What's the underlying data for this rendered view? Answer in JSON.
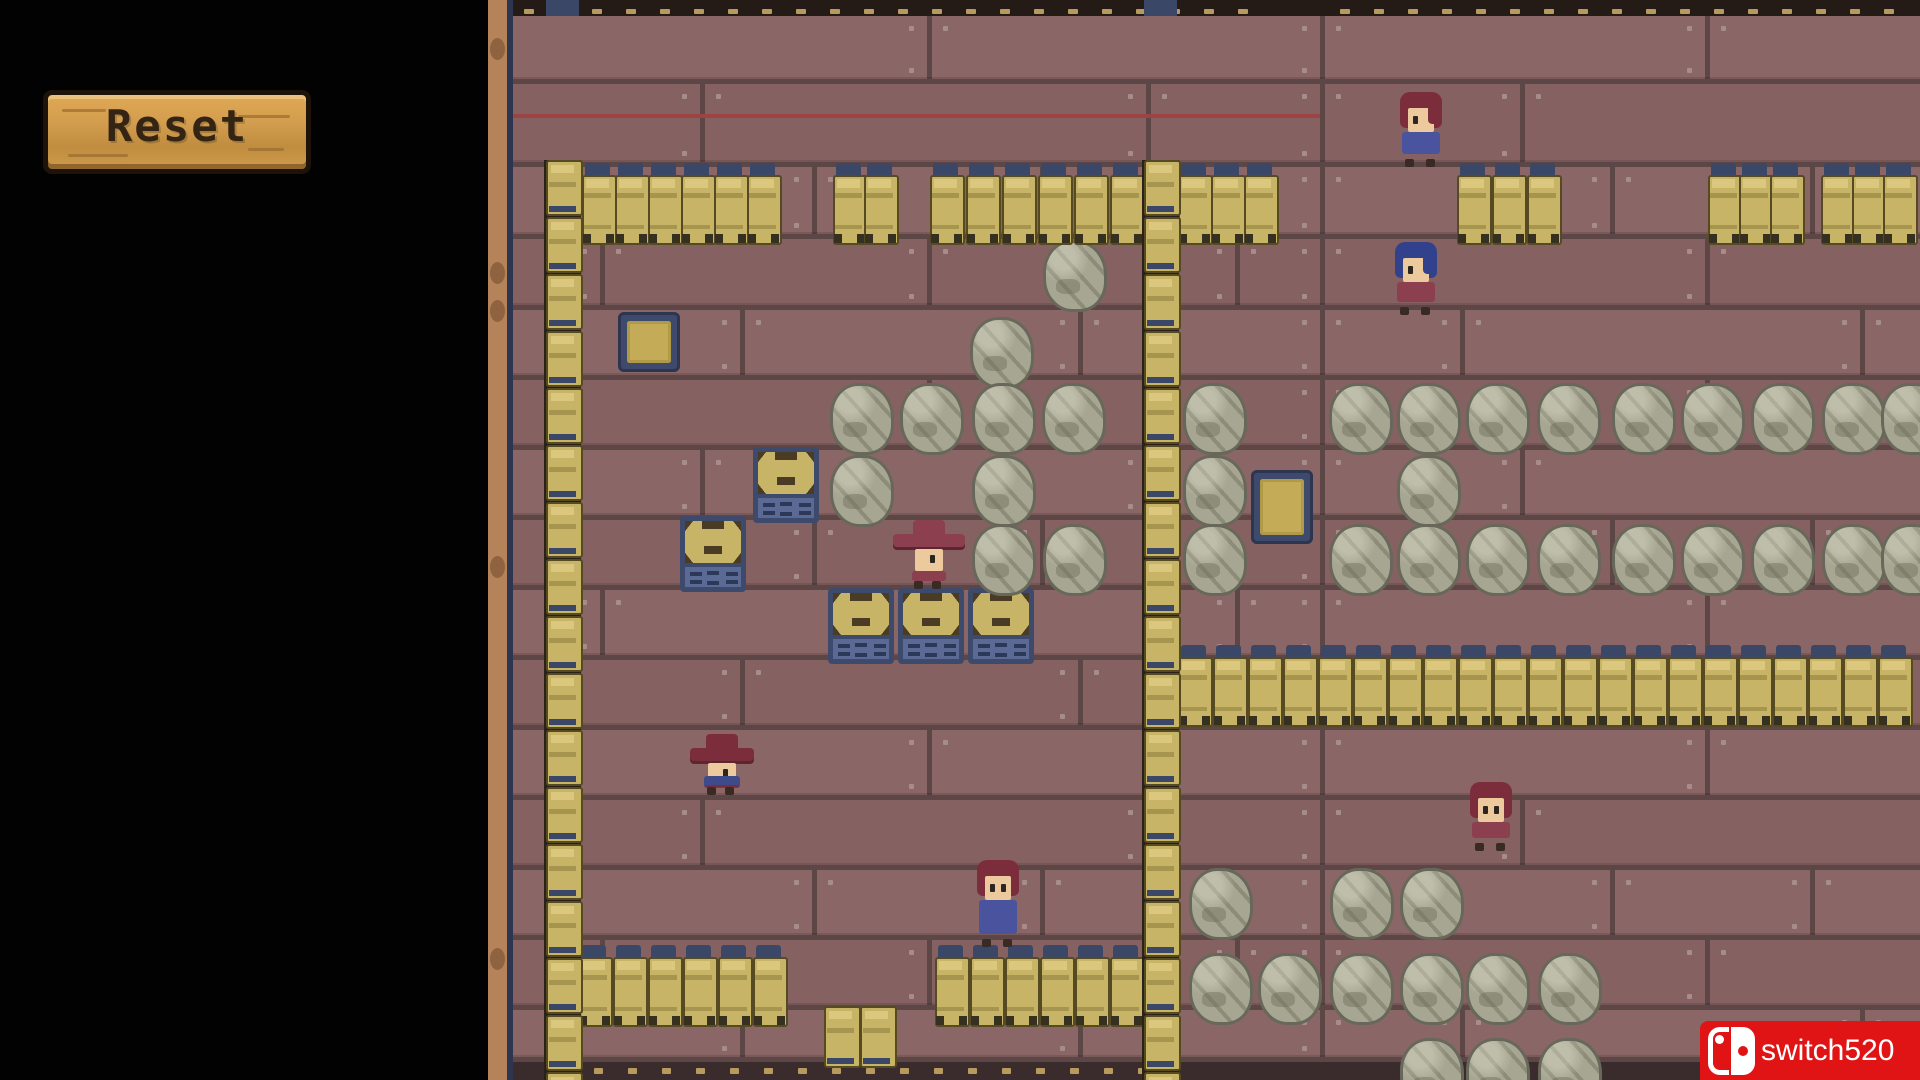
{
  "sidebar": {
    "reset_label": "Reset"
  },
  "watermark": {
    "text": "switch520",
    "bg": "#e01414",
    "fg": "#ffffff"
  },
  "palette": {
    "plank": "#8b6666",
    "plank_alt": "#866161",
    "seam": "#5d4646",
    "seam_red": "#9c4343",
    "nail": "#a78c8c",
    "strip_dark": "#241b17",
    "strip_bottom": "#3a2c2c",
    "navy": "#3b4766",
    "edge_navy": "#2e3550",
    "beam": "#b5835a",
    "barrel": "#c8b466",
    "barrel_light": "#dbc87e",
    "barrel_band": "#a6954f",
    "rock": "#a6a692",
    "crate_top": "#c8b466",
    "crate_bottom": "#5a6a94",
    "crate_frame": "#3e4a6b",
    "switch_gold": "#c3ab57",
    "skin": "#ecca9e"
  },
  "game": {
    "top_strip": {
      "y": 0,
      "h": 16,
      "x1": 513,
      "x2": 1920
    },
    "bottom_strip": {
      "y": 1062,
      "h": 18,
      "x1": 513,
      "x2": 1920,
      "dash_x1": 560,
      "dash_x2": 1145
    },
    "red_seam": {
      "y": 114,
      "x1": 513,
      "x2": 1320
    },
    "seam_rows": [
      16,
      84,
      167,
      239,
      310,
      380,
      450,
      520,
      590,
      660,
      730,
      800,
      870,
      940,
      1010
    ],
    "wall_columns": [
      {
        "x": 546,
        "y1": 160,
        "y2": 1080
      },
      {
        "x": 1144,
        "y1": 160,
        "y2": 1080
      }
    ],
    "barrel_rows": [
      {
        "x": 582,
        "y": 163,
        "count": 6,
        "pitch": 33
      },
      {
        "x": 833,
        "y": 163,
        "count": 2,
        "pitch": 31
      },
      {
        "x": 930,
        "y": 163,
        "count": 6,
        "pitch": 36
      },
      {
        "x": 1178,
        "y": 163,
        "count": 3,
        "pitch": 33
      },
      {
        "x": 1457,
        "y": 163,
        "count": 3,
        "pitch": 35
      },
      {
        "x": 1708,
        "y": 163,
        "count": 3,
        "pitch": 31
      },
      {
        "x": 1821,
        "y": 163,
        "count": 3,
        "pitch": 31
      },
      {
        "x": 1178,
        "y": 645,
        "count": 21,
        "pitch": 35
      },
      {
        "x": 578,
        "y": 945,
        "count": 6,
        "pitch": 35
      },
      {
        "x": 935,
        "y": 945,
        "count": 6,
        "pitch": 35
      }
    ],
    "small_kegs": [
      {
        "x": 824,
        "y": 1006
      },
      {
        "x": 860,
        "y": 1006
      }
    ],
    "rocks": [
      {
        "x": 1043,
        "y": 240
      },
      {
        "x": 970,
        "y": 317
      },
      {
        "x": 830,
        "y": 383
      },
      {
        "x": 900,
        "y": 383
      },
      {
        "x": 972,
        "y": 383
      },
      {
        "x": 1042,
        "y": 383
      },
      {
        "x": 830,
        "y": 455
      },
      {
        "x": 972,
        "y": 455
      },
      {
        "x": 972,
        "y": 524
      },
      {
        "x": 1043,
        "y": 524
      },
      {
        "x": 1183,
        "y": 383
      },
      {
        "x": 1329,
        "y": 383
      },
      {
        "x": 1397,
        "y": 383
      },
      {
        "x": 1466,
        "y": 383
      },
      {
        "x": 1537,
        "y": 383
      },
      {
        "x": 1612,
        "y": 383
      },
      {
        "x": 1681,
        "y": 383
      },
      {
        "x": 1751,
        "y": 383
      },
      {
        "x": 1822,
        "y": 383
      },
      {
        "x": 1881,
        "y": 383
      },
      {
        "x": 1183,
        "y": 455
      },
      {
        "x": 1397,
        "y": 455
      },
      {
        "x": 1183,
        "y": 524
      },
      {
        "x": 1329,
        "y": 524
      },
      {
        "x": 1397,
        "y": 524
      },
      {
        "x": 1466,
        "y": 524
      },
      {
        "x": 1537,
        "y": 524
      },
      {
        "x": 1612,
        "y": 524
      },
      {
        "x": 1681,
        "y": 524
      },
      {
        "x": 1751,
        "y": 524
      },
      {
        "x": 1822,
        "y": 524
      },
      {
        "x": 1881,
        "y": 524
      },
      {
        "x": 1189,
        "y": 868
      },
      {
        "x": 1330,
        "y": 868
      },
      {
        "x": 1400,
        "y": 868
      },
      {
        "x": 1189,
        "y": 953
      },
      {
        "x": 1258,
        "y": 953
      },
      {
        "x": 1330,
        "y": 953
      },
      {
        "x": 1400,
        "y": 953
      },
      {
        "x": 1466,
        "y": 953
      },
      {
        "x": 1538,
        "y": 953
      },
      {
        "x": 1400,
        "y": 1038
      },
      {
        "x": 1466,
        "y": 1038
      },
      {
        "x": 1538,
        "y": 1038
      }
    ],
    "crates": [
      {
        "x": 753,
        "y": 447
      },
      {
        "x": 680,
        "y": 516
      },
      {
        "x": 828,
        "y": 588
      },
      {
        "x": 898,
        "y": 588
      },
      {
        "x": 968,
        "y": 588
      }
    ],
    "switch_tiles": [
      {
        "x": 618,
        "y": 312,
        "w": 62,
        "h": 60
      },
      {
        "x": 1251,
        "y": 470,
        "w": 62,
        "h": 74
      }
    ],
    "characters": [
      {
        "id": "char-top-right",
        "x": 1396,
        "y": 92,
        "w": 50,
        "h": 76,
        "variant": "plain",
        "hair": "#7b2d3c",
        "body": "#4a549e",
        "eyes": 1
      },
      {
        "id": "char-blue-hair",
        "x": 1392,
        "y": 242,
        "w": 48,
        "h": 74,
        "variant": "plain",
        "hair": "#31418c",
        "body": "#8c3f4f",
        "eyes": 1
      },
      {
        "id": "char-cowboy-center",
        "x": 893,
        "y": 518,
        "w": 72,
        "h": 70,
        "variant": "hat",
        "hat": "#8c3f4f",
        "body": "#8c3f4f",
        "scarf": false
      },
      {
        "id": "char-hat-left",
        "x": 690,
        "y": 732,
        "w": 64,
        "h": 62,
        "variant": "hat",
        "hat": "#7b2d3c",
        "body": "#7b2d3c",
        "scarf": true
      },
      {
        "id": "char-bottom-center",
        "x": 973,
        "y": 860,
        "w": 50,
        "h": 88,
        "variant": "plain",
        "hair": "#7b2d3c",
        "body": "#4a549e",
        "eyes": 2
      },
      {
        "id": "char-right-mid",
        "x": 1468,
        "y": 782,
        "w": 46,
        "h": 70,
        "variant": "plain",
        "hair": "#7b2d3c",
        "body": "#8c3f4f",
        "eyes": 2
      }
    ]
  }
}
